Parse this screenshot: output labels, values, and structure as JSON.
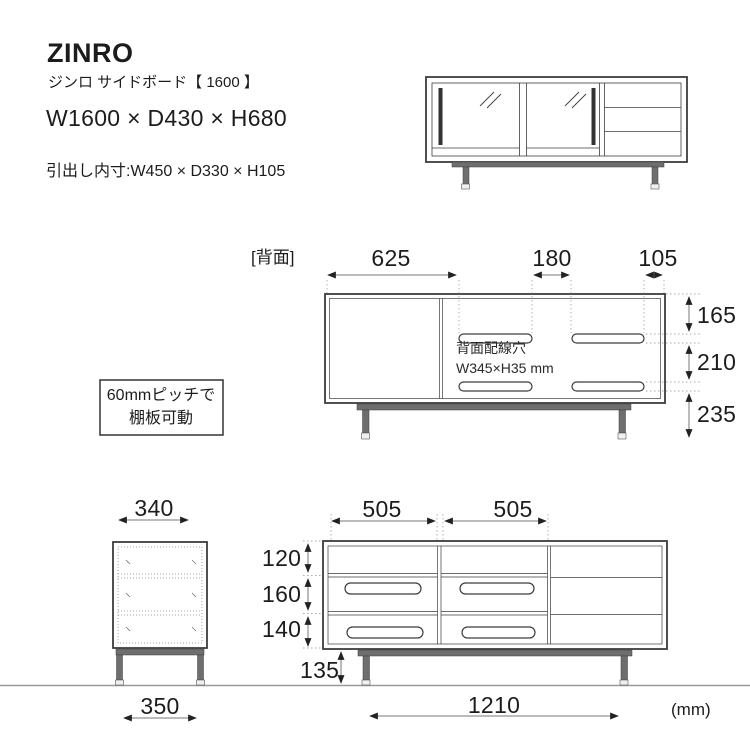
{
  "header": {
    "brand": "ZINRO",
    "subtitle": "ジンロ サイドボード【 1600 】",
    "size": "W1600 × D430 × H680",
    "drawer_inner": "引出し内寸:W450 × D330 × H105"
  },
  "back_view": {
    "label": "[背面]",
    "dim_625": "625",
    "dim_180": "180",
    "dim_105": "105",
    "dim_165": "165",
    "dim_210": "210",
    "dim_235": "235",
    "note1": "背面配線穴",
    "note2": "W345×H35 mm"
  },
  "shelf_note": {
    "line1": "60mmピッチで",
    "line2": "棚板可動"
  },
  "side_view": {
    "dim_340": "340",
    "dim_350": "350"
  },
  "front_view": {
    "dim_505a": "505",
    "dim_505b": "505",
    "dim_120": "120",
    "dim_160": "160",
    "dim_140": "140",
    "dim_135": "135",
    "dim_1210": "1210"
  },
  "unit": "(mm)",
  "colors": {
    "line": "#3c3c3c",
    "dimension_line": "#777777",
    "arrowhead": "#222222",
    "leader": "#aaaaaa",
    "leg_fill": "#6e6e6e",
    "ground": "#999999"
  }
}
